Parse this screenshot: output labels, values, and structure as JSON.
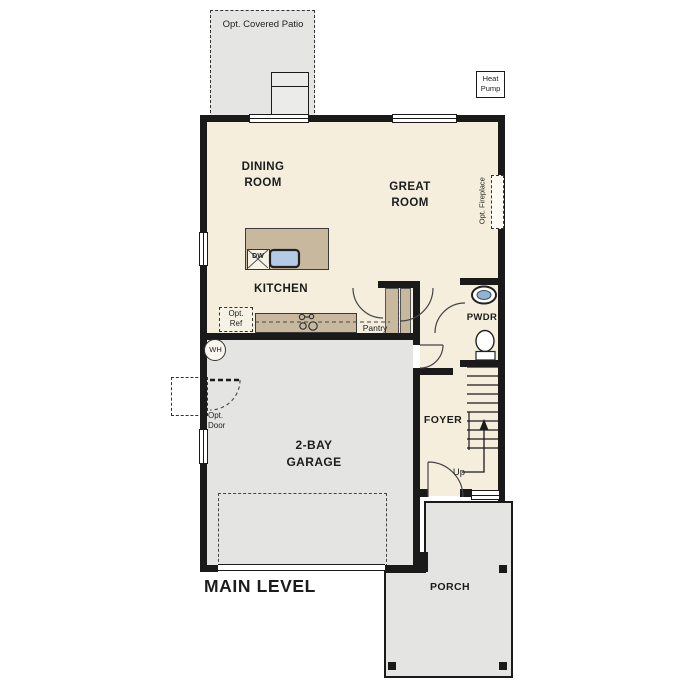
{
  "plan": {
    "title": "MAIN LEVEL",
    "colors": {
      "interior_floor": "#f5eedd",
      "garage_porch_patio": "#e4e4e2",
      "counters": "#c8b99e",
      "sink_blue": "#b3cbe7",
      "walls": "#1a1a1a"
    },
    "rooms": {
      "dining": "DINING\nROOM",
      "great": "GREAT\nROOM",
      "kitchen": "KITCHEN",
      "garage": "2-BAY\nGARAGE",
      "foyer": "FOYER",
      "powder": "PWDR",
      "pantry": "Pantry",
      "porch": "PORCH"
    },
    "outdoor": {
      "patio": "Opt. Covered Patio",
      "heat_pump": "Heat\nPump",
      "opt_door": "Opt.\nDoor"
    },
    "fixtures": {
      "dishwasher": "DW",
      "water_heater": "WH",
      "opt_ref": "Opt.\nRef",
      "opt_fireplace": "Opt. Fireplace",
      "stairs_up": "Up"
    }
  }
}
